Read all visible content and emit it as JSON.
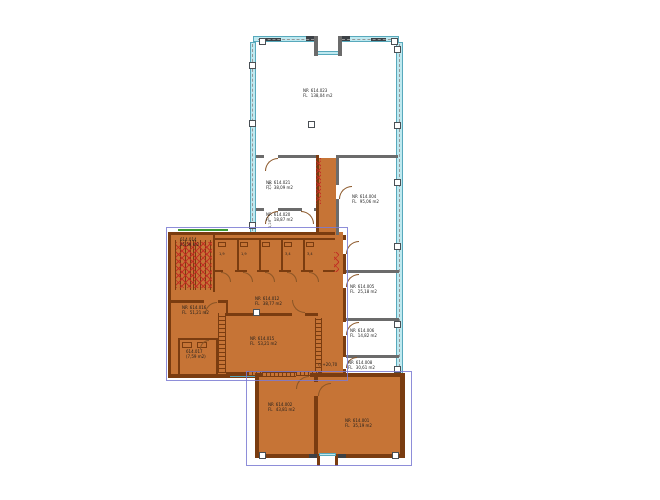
{
  "drawing": {
    "type": "architectural-floor-plan",
    "prefixes": [
      "NR",
      "FL"
    ],
    "colors": {
      "highlight_fill": "#c67436",
      "highlight_wall": "#7a3c10",
      "wall": "#6b6b6b",
      "glass_facade": "#bfe9f0",
      "hatch_red": "#c22a22",
      "selection_blue": "#8a8ad2",
      "green_marker": "#3a9b35"
    }
  },
  "rooms": [
    {
      "number": "614.023",
      "area": "138,04 m2",
      "highlighted": false
    },
    {
      "number": "614.021",
      "area": "38,09 m2",
      "highlighted": false
    },
    {
      "number": "614.020",
      "area": "18,87 m2",
      "highlighted": false
    },
    {
      "number": "614.004",
      "area": "95,06 m2",
      "highlighted": false
    },
    {
      "number": "614.005",
      "area": "25,18 m2",
      "highlighted": false
    },
    {
      "number": "614.006",
      "area": "14,82 m2",
      "highlighted": false
    },
    {
      "number": "614.008",
      "area": "30,61 m2",
      "highlighted": false
    },
    {
      "number": "614.014",
      "area": "25,58 m2",
      "highlighted": true
    },
    {
      "number": "614.012",
      "area": "38,77 m2",
      "highlighted": true
    },
    {
      "number": "614.016",
      "area": "51,21 m2",
      "highlighted": true
    },
    {
      "number": "614.017",
      "area": "(7,59 m2)",
      "highlighted": true
    },
    {
      "number": "614.015",
      "area": "53,21 m2",
      "highlighted": true
    },
    {
      "number": "614.002",
      "area": "43,81 m2",
      "highlighted": true
    },
    {
      "number": "614.001",
      "area": "35,19 m2",
      "highlighted": true
    }
  ],
  "wc_cells": [
    {
      "area": "1,9"
    },
    {
      "area": "1,9"
    },
    {
      "area": "3,4"
    },
    {
      "area": "3,4"
    }
  ],
  "annotations": {
    "level": "+20,70",
    "dim_a": "1,28",
    "dim_b": "1,28",
    "level_icon": "◇"
  }
}
